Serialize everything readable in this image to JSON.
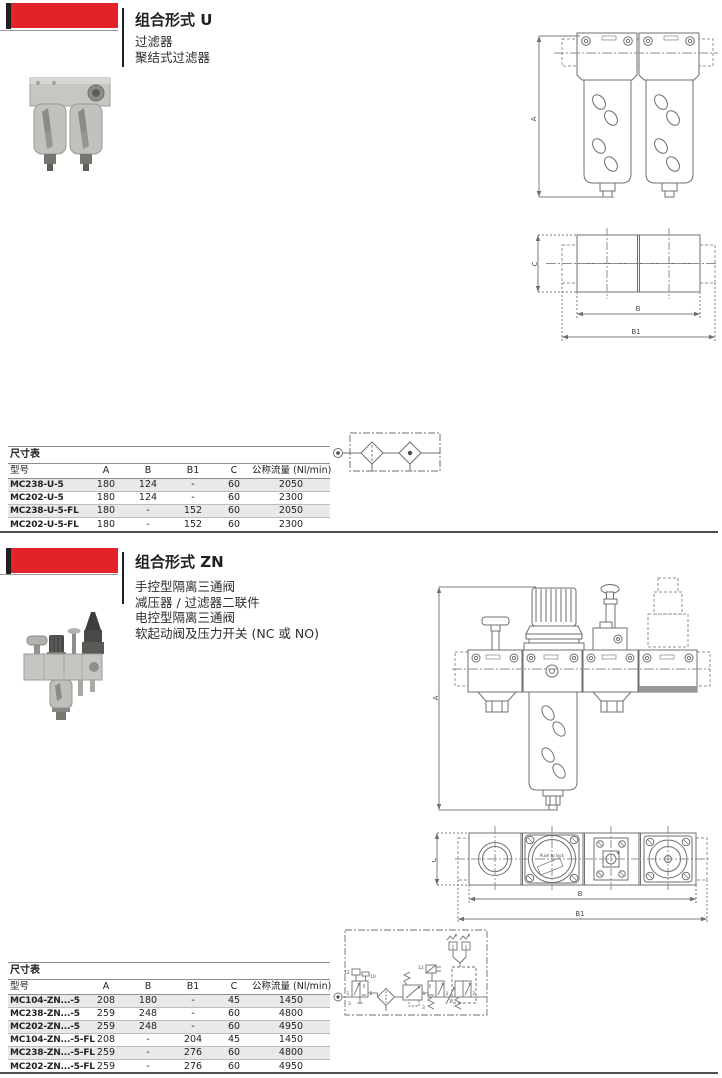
{
  "section_u": {
    "title": "组合形式 U",
    "desc": [
      "过滤器",
      "聚结式过滤器"
    ]
  },
  "section_zn": {
    "title": "组合形式 ZN",
    "desc": [
      "手控型隔离三通阀",
      "减压器 / 过滤器二联件",
      "电控型隔离三通阀",
      "软起动阀及压力开关 (NC 或 NO)"
    ]
  },
  "dims": {
    "a": "A",
    "b": "B",
    "b1": "B1",
    "c": "C"
  },
  "drawing_labels": {
    "gauge_text": "Push to lock"
  },
  "schematic_labels": {
    "p1": "1",
    "p2": "2",
    "p3": "3",
    "p10": "10",
    "p12": "12"
  },
  "table_u": {
    "caption": "尺寸表",
    "headers": {
      "model": "型号",
      "a": "A",
      "b": "B",
      "b1": "B1",
      "c": "C",
      "flow": "公称流量 (Nl/min)"
    },
    "rows": [
      {
        "model": "MC238-U-5",
        "a": "180",
        "b": "124",
        "b1": "-",
        "c": "60",
        "flow": "2050"
      },
      {
        "model": "MC202-U-5",
        "a": "180",
        "b": "124",
        "b1": "-",
        "c": "60",
        "flow": "2300"
      },
      {
        "model": "MC238-U-5-FL",
        "a": "180",
        "b": "-",
        "b1": "152",
        "c": "60",
        "flow": "2050"
      },
      {
        "model": "MC202-U-5-FL",
        "a": "180",
        "b": "-",
        "b1": "152",
        "c": "60",
        "flow": "2300"
      }
    ]
  },
  "table_zn": {
    "caption": "尺寸表",
    "headers": {
      "model": "型号",
      "a": "A",
      "b": "B",
      "b1": "B1",
      "c": "C",
      "flow": "公称流量 (Nl/min)"
    },
    "rows": [
      {
        "model": "MC104-ZN...-5",
        "a": "208",
        "b": "180",
        "b1": "-",
        "c": "45",
        "flow": "1450"
      },
      {
        "model": "MC238-ZN...-5",
        "a": "259",
        "b": "248",
        "b1": "-",
        "c": "60",
        "flow": "4800"
      },
      {
        "model": "MC202-ZN...-5",
        "a": "259",
        "b": "248",
        "b1": "-",
        "c": "60",
        "flow": "4950"
      },
      {
        "model": "MC104-ZN...-5-FL",
        "a": "208",
        "b": "-",
        "b1": "204",
        "c": "45",
        "flow": "1450"
      },
      {
        "model": "MC238-ZN...-5-FL",
        "a": "259",
        "b": "-",
        "b1": "276",
        "c": "60",
        "flow": "4800"
      },
      {
        "model": "MC202-ZN...-5-FL",
        "a": "259",
        "b": "-",
        "b1": "276",
        "c": "60",
        "flow": "4950"
      }
    ]
  },
  "colors": {
    "accent_red": "#e42229",
    "header_black": "#231f20",
    "row_alt": "#e9e9e9"
  }
}
